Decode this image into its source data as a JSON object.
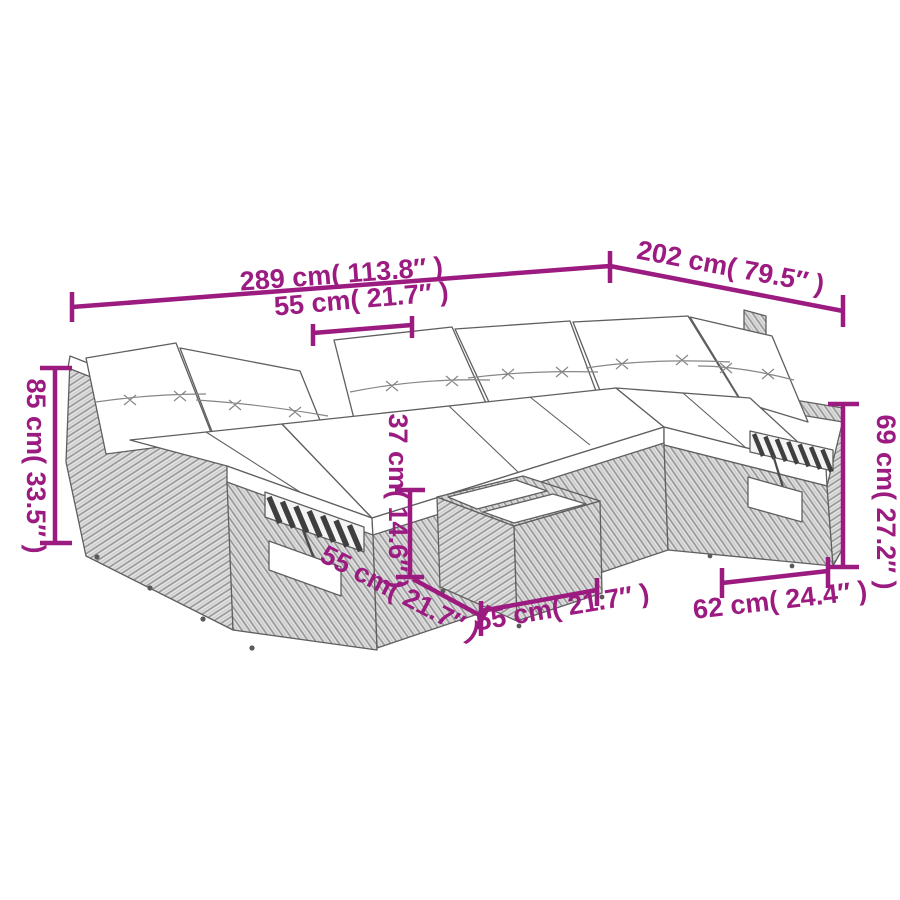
{
  "diagram": {
    "type": "product-dimension-diagram",
    "subject": "rattan-garden-lounge-set-with-table",
    "background": "#ffffff",
    "accent_color": "#9b1b80",
    "line_art_color": "#5f5f5f",
    "labels": {
      "overall_width": "289 cm( 113.8″ )",
      "overall_depth": "202 cm( 79.5″ )",
      "module_width": "55 cm( 21.7″ )",
      "overall_height": "85 cm( 33.5″ )",
      "table_height": "37 cm( 14.6″ )",
      "table_depth": "55 cm( 21.7″ )",
      "table_width": "55 cm( 21.7″ )",
      "base_depth": "62 cm( 24.4″ )",
      "back_height": "69 cm( 27.2″ )"
    }
  }
}
